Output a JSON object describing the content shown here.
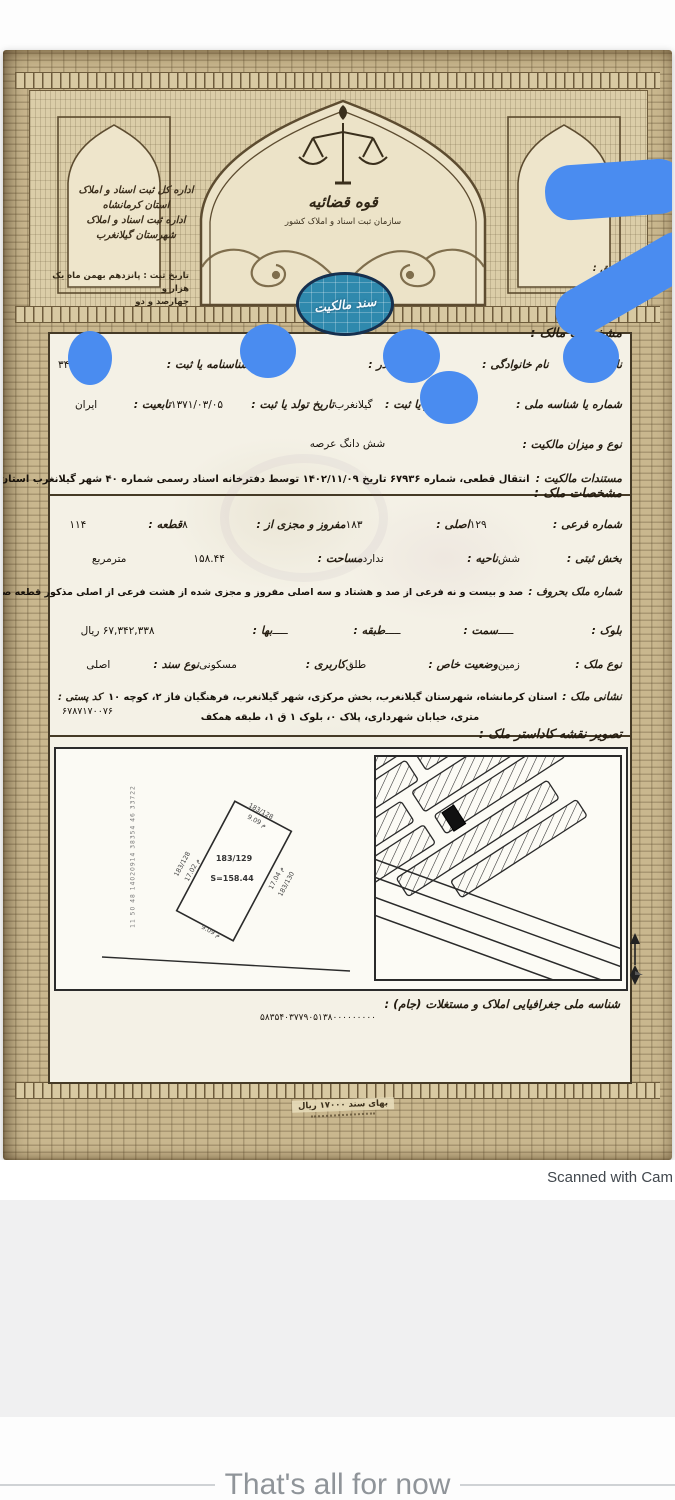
{
  "colors": {
    "redaction_blue": "#4a8cf0",
    "seal_teal": "#2f89ad",
    "paper_tan": "#c9b78e",
    "card_cream": "#f4f1e6",
    "ink": "#241c10"
  },
  "header": {
    "left_office_lines": [
      "اداره کل ثبت اسناد و املاک",
      "استان کرمانشاه",
      "اداره ثبت اسناد و املاک",
      "شهرستان گیلانغرب"
    ],
    "reg_date_label": "تاریخ ثبت :",
    "reg_date_line1": "پانزدهم بهمن ماه یک هزار و",
    "reg_date_line2": "چهارصد و دو",
    "judiciary_title": "قوه قضائیه",
    "org_subtitle": "سازمان ثبت اسناد و املاک کشور",
    "verify_code_label": "رمز تصدیق :",
    "seal_text": "سند مالکیت"
  },
  "owner": {
    "section_title": "مشخصات مالک :",
    "row1": [
      {
        "label": "نام :",
        "value": ""
      },
      {
        "label": "نام خانوادگی :",
        "value": ""
      },
      {
        "label": "نام پدر :",
        "value": ""
      },
      {
        "label": "شماره شناسنامه یا ثبت :",
        "value": "۳۴"
      }
    ],
    "row2": [
      {
        "label": "شماره یا شناسه ملی :",
        "value": ""
      },
      {
        "label": "محل صدور یا ثبت :",
        "value": "گیلانغرب"
      },
      {
        "label": "تاریخ تولد یا ثبت :",
        "value": "۱۳۷۱/۰۳/۰۵"
      },
      {
        "label": "تابعیت :",
        "value": "ایران"
      }
    ],
    "ownership_label": "نوع و میزان مالکیت :",
    "ownership_value": "شش دانگ عرصه",
    "evidence_label": "مستندات مالکیت :",
    "evidence_value": "انتقال قطعی، شماره ۶۷۹۳۶ تاریخ ۱۴۰۲/۱۱/۰۹ توسط دفترخانه اسناد رسمی شماره ۴۰ شهر گیلانغرب استان کرمانشاه"
  },
  "property": {
    "section_title": "مشخصات ملک :",
    "row1": [
      {
        "label": "شماره فرعی :",
        "value": "۱۲۹"
      },
      {
        "label": "اصلی :",
        "value": "۱۸۳"
      },
      {
        "label": "مفروز و مجزی از :",
        "value": "۸"
      },
      {
        "label": "قطعه :",
        "value": "۱۱۴"
      }
    ],
    "row2": [
      {
        "label": "بخش ثبتی :",
        "value": "شش"
      },
      {
        "label": "ناحیه :",
        "value": "ندارد"
      },
      {
        "label": "مساحت :",
        "value": "۱۵۸.۴۴"
      },
      {
        "label": "",
        "value": "مترمربع"
      }
    ],
    "words_label": "شماره ملک بحروف :",
    "words_value": "صد و بیست و نه فرعی از صد و هشتاد و سه اصلی مفروز و مجزی شده از هشت فرعی از اصلی مذکور قطعه صد و چهارده تفکیکی",
    "row4": [
      {
        "label": "بلوک :",
        "value": "ـــــ"
      },
      {
        "label": "سمت :",
        "value": "ـــــ"
      },
      {
        "label": "طبقه :",
        "value": "ـــــ"
      },
      {
        "label": "بها :",
        "value": "۶۷,۳۴۲,۳۳۸ ریال"
      }
    ],
    "row5": [
      {
        "label": "نوع ملک :",
        "value": "زمین"
      },
      {
        "label": "وضعیت خاص :",
        "value": "طلق"
      },
      {
        "label": "کاربری :",
        "value": "مسکونی"
      },
      {
        "label": "نوع سند :",
        "value": "اصلی"
      }
    ],
    "address_label": "نشانی ملک :",
    "address_line1": "استان کرمانشاه، شهرستان گیلانغرب، بخش مرکزی، شهر گیلانغرب، فرهنگیان فاز ۲، کوچه ۱۰",
    "address_line2": "متری، خیابان شهرداری، پلاک ۰، بلوک ۱ ق ۱، طبقه همکف",
    "postal_label": "کد پستی :",
    "postal_value": "۶۷۸۷۱۷۰۰۷۶"
  },
  "map": {
    "section_title": "تصویر نقشه کاداستر ملک :",
    "parcel_no": "183/129",
    "parcel_area": "S=158.44",
    "edge_top_no": "183/128",
    "edge_top_len": "9.09 م",
    "edge_left_no": "183/128",
    "edge_left_len": "17.02 م",
    "edge_right_no": "183/130",
    "edge_right_len": "17.04 م",
    "edge_bottom_len": "9.09 م",
    "side_note": "11 50 48 14020914 38354 46 33722"
  },
  "jam": {
    "label": "شناسه ملی جغرافیایی املاک و مستغلات (جام) :",
    "value": "۵۸۳۵۴۰۳۷۷۹۰۵۱۳۸۰۰۰۰۰۰۰۰۰"
  },
  "doc_footer": {
    "price": "بهای سند ۱۷۰۰۰ ریال"
  },
  "app": {
    "scan_caption": "Scanned with Cam",
    "end_marker": "That's all for now"
  }
}
